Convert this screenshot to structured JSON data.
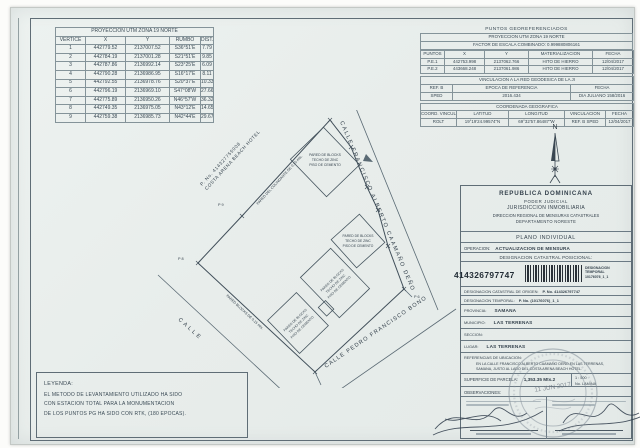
{
  "utm_table": {
    "title": "PROYECCION UTM ZONA 19 NORTE",
    "headers": [
      "VERTICE",
      "X",
      "Y",
      "RUMBO",
      "DIST."
    ],
    "rows": [
      [
        "1",
        "442779.52",
        "2137007.52",
        "S36°51'E",
        "7.79"
      ],
      [
        "2",
        "442784.19",
        "2137001.28",
        "S21°51'E",
        "9.85"
      ],
      [
        "3",
        "442787.86",
        "2136992.14",
        "S23°25'E",
        "6.09"
      ],
      [
        "4",
        "442790.28",
        "2136986.95",
        "S16°17'E",
        "8.11"
      ],
      [
        "5",
        "442792.55",
        "2136978.76",
        "S20°37'E",
        "10.33"
      ],
      [
        "6",
        "442796.19",
        "2136969.10",
        "S47°08'W",
        "27.66"
      ],
      [
        "7",
        "442775.89",
        "2136950.26",
        "N46°57'W",
        "36.32"
      ],
      [
        "8",
        "442749.35",
        "2136975.05",
        "N43°12'E",
        "14.65"
      ],
      [
        "9",
        "442759.38",
        "2136985.73",
        "N42°44'E",
        "29.67"
      ]
    ]
  },
  "geo_tables": {
    "title": "PUNTOS GEOREFERENCIADOS",
    "subtitle": "PROYECCION UTM ZONA 19 NORTE",
    "scale_factor": "FACTOR DE ESCALA COMBINADO:   0.999880806161",
    "points_headers": [
      "PUNTOS",
      "X",
      "Y",
      "MATERIALIZACION",
      "FECHA"
    ],
    "points_rows": [
      [
        "P.E.1",
        "442753.998",
        "2137062.766",
        "HITO DE HIERRO",
        "12/04/2017"
      ],
      [
        "P.E.2",
        "443668.248",
        "2137061.986",
        "HITO DE HIERRO",
        "12/04/2017"
      ]
    ],
    "vinculacion_title": "VINCULACION A LA RED GEODESICA DE LA JI",
    "ref_headers": [
      "REF. B",
      "EPOCA DE REFERENCIA",
      "FECHA"
    ],
    "ref_row": [
      "SPED",
      "2016.434",
      "DIA JULIANO 158/2016"
    ],
    "coord_title": "COORDENADA GEOGRAFICA",
    "coord_headers": [
      "COORD. VINCULADA",
      "LATITUD",
      "LONGITUD",
      "VINCULACION",
      "FECHA"
    ],
    "coord_row": [
      "ROLT",
      "19°19'24.99574\"N",
      "69°32'57.86487\"W",
      "REF. B SPED",
      "12/04/2017"
    ]
  },
  "plan": {
    "street_ne": "CALLE FRANCISCO ALBERTO CAAMAÑO DEÑO",
    "street_se": "CALLE PEDRO FRANCISCO BONO",
    "street_sw": "CALLE",
    "neighbor_parcel_no": "P. No. 414327755008",
    "neighbor_name": "COSTA ARENA BEACH HOTEL",
    "wall_nw": "PARED DEL COLINDANTE DE 0.15 mts.",
    "wall_sw": "PARED BLOCKS DE 0.15 mts.",
    "building_label": [
      "PARED DE BLOCKS",
      "TECHO DE ZINC",
      "PISO DE CEMENTO"
    ],
    "point_p6": "P 6",
    "point_p8": "P 8",
    "point_p9": "P 9",
    "north": "N"
  },
  "title_block": {
    "country": "REPUBLICA  DOMINICANA",
    "org1": "PODER  JUDICIAL",
    "org2": "JURISDICCION INMOBILIARIA",
    "org3": "DIRECCION REGIONAL DE MENSURAS CATASTRALES",
    "org4": "DEPARTAMENTO NORESTE",
    "doc_type": "PLANO INDIVIDUAL",
    "operacion_label": "OPERACION:",
    "operacion_value": "ACTUALIZACION DE MENSURA",
    "desig_pos_label": "DESIGNACION CATASTRAL POSICIONAL:",
    "barcode_number": "414326797747",
    "desig_temp_label": "DESIGNACION TEMPORAL",
    "desig_temp_value": "10176076_1_1",
    "origen_label": "DESIGNACION CATASTRAL DE ORIGEN:",
    "origen_value": "P. No. 414326797747",
    "temporal_label": "DESIGNACION TEMPORAL:",
    "temporal_value": "P. No. (10176076)_1_1",
    "provincia_label": "PROVINCIA:",
    "provincia_value": "SAMANA",
    "municipio_label": "MUNICIPIO:",
    "municipio_value": "LAS TERRENAS",
    "seccion_label": "SECCION:",
    "lugar_label": "LUGAR:",
    "lugar_value": "LAS TERRENAS",
    "referencias_label": "REFERENCIAS DE UBICACION:",
    "referencias_lines": [
      "EN LA CALLE FRANCISCO ALBERTO CAAMAÑO DEÑO EN LAS TERRENAS,",
      "SAMANA, JUSTO AL LADO DEL COSTA ARENA BEACH HOTEL."
    ],
    "superficie_label": "SUPERFICIE DE PARCELA:",
    "superficie_value": "1,353.35 Mts.2",
    "escala_value": "1 : 500",
    "lamina_label": "No. LAMINA",
    "observaciones_label": "OBSERVACIONES:",
    "stamp_date": "11 JUN 2017"
  },
  "legend": {
    "title": "LEYENDA:",
    "lines": [
      "EL METODO DE LEVANTAMIENTO UTILIZADO HA SIDO",
      "CON ESTACION TOTAL PARA LA MONUMENTACION",
      "DE LOS PUNTOS PG HA SIDO CON RTK, (180 EPOCAS)."
    ]
  }
}
